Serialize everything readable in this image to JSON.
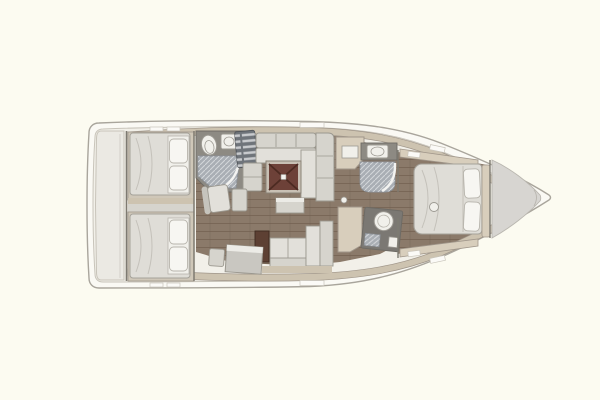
{
  "meta": {
    "subject": "sailing-yacht-interior-floor-plan",
    "view": "top-down",
    "bow_direction": "right",
    "visible_text": ""
  },
  "colors": {
    "background": "#FCFBF1",
    "hull_rim": "#FAF9F4",
    "hull_stroke": "#A9A59C",
    "deck": "#F2F0E9",
    "deck_stroke": "#C8C4BA",
    "wall_tan": "#CDC3B0",
    "wall_stroke": "#A0968A",
    "platform": "#EBE9E3",
    "platform_line": "#D3D0C9",
    "bulkhead": "#7E7A71",
    "floor_wood": "#8B7A6A",
    "cabin_trim": "#CFC7B8",
    "furniture": "#D6D4CD",
    "furniture_light": "#E2E0DA",
    "furniture_stroke": "#9B988F",
    "furniture_dark": "#C6C4BD",
    "bed": "#DFDDD7",
    "bed_stroke": "#A5A29A",
    "bed_seam": "#C4C1BA",
    "pillow": "#F7F6F2",
    "pillow_stroke": "#B7B4AC",
    "fixture_white": "#F1F0EB",
    "fixture_stroke": "#9C9992",
    "counter_dark": "#8D8A83",
    "counter_edge": "#6E6B65",
    "vanity_dark": "#7B7873",
    "shower_floor": "#A9AEB4",
    "shower_stroke": "#8A8F95",
    "shower_glass": "#F3F3F1",
    "steps_dark": "#6F747A",
    "steps_stroke": "#53575C",
    "table_frame": "#C8C0B4",
    "table_frame_stroke": "#8A8377",
    "table_top": "#6D4138",
    "table_cross": "#4C2A21",
    "table_center": "#F2F1ED",
    "wood_dark": "#5D4033",
    "wood_dark_stroke": "#3F2A20",
    "cabinet_tan": "#D8CEBC",
    "bow_deck": "#D7D5D1",
    "bow_deck_stroke": "#B9B6AF",
    "window_white": "#FBFAF7",
    "desk": "#C9C7C1",
    "desk_edge": "#ECEBE6"
  },
  "regions": [
    {
      "id": "transom-platform",
      "label": "transom swim platform"
    },
    {
      "id": "aft-cabin-port",
      "label": "aft double cabin port"
    },
    {
      "id": "aft-cabin-starboard",
      "label": "aft double cabin starboard"
    },
    {
      "id": "aft-heads",
      "label": "aft heads with shower"
    },
    {
      "id": "companionway-steps",
      "label": "companionway steps"
    },
    {
      "id": "saloon",
      "label": "saloon with settees and folding table"
    },
    {
      "id": "nav-station",
      "label": "chart table"
    },
    {
      "id": "galley",
      "label": "galley cabinets"
    },
    {
      "id": "forward-shower",
      "label": "forward shower compartment"
    },
    {
      "id": "forward-heads",
      "label": "forward heads vanity"
    },
    {
      "id": "owner-cabin",
      "label": "forward owner cabin with island bed"
    },
    {
      "id": "bow-deck",
      "label": "bow deck"
    }
  ]
}
